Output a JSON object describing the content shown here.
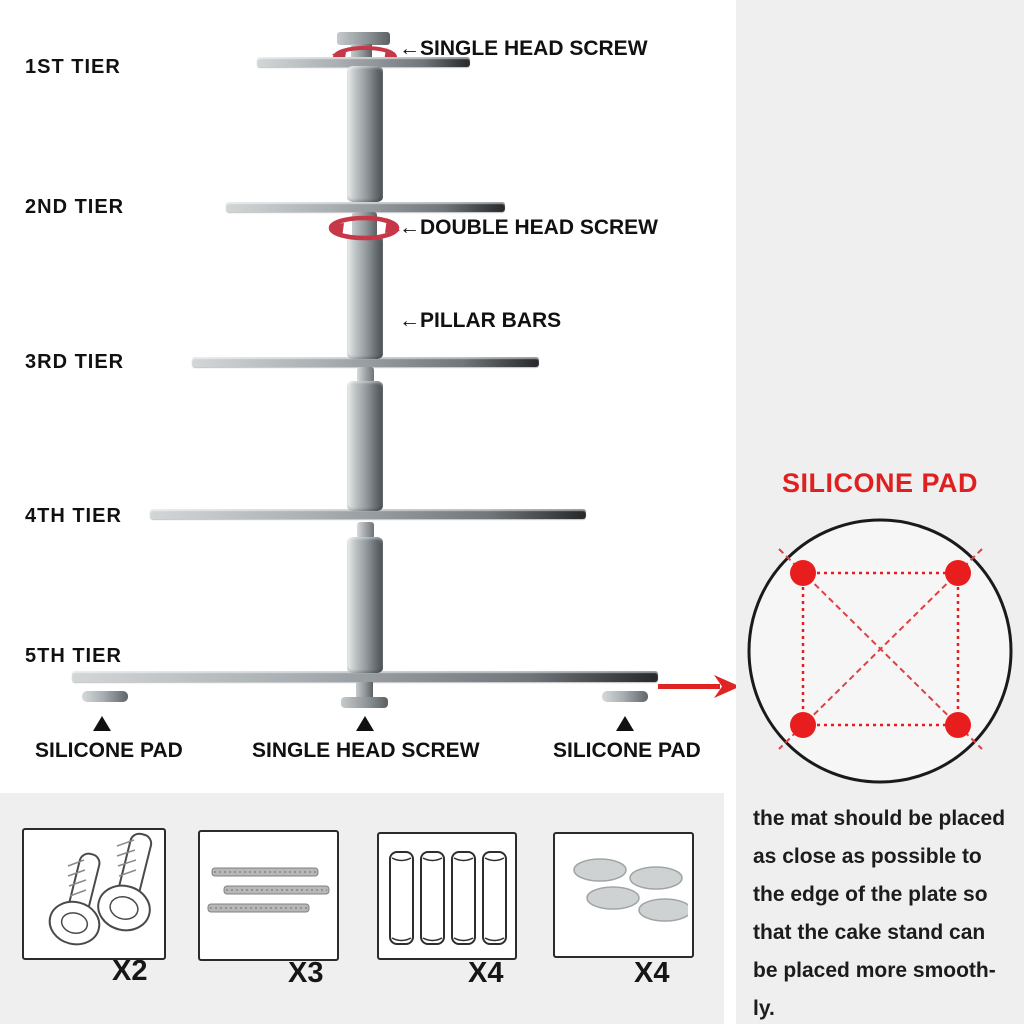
{
  "colors": {
    "accent_red": "#e02020",
    "rotation_arrow_red": "#c63848",
    "panel_bg": "#efefef",
    "ink": "#111111"
  },
  "diagram": {
    "tiers": [
      {
        "label": "1ST TIER"
      },
      {
        "label": "2ND TIER"
      },
      {
        "label": "3RD TIER"
      },
      {
        "label": "4TH TIER"
      },
      {
        "label": "5TH TIER"
      }
    ],
    "callouts": {
      "single_head_screw": "←SINGLE HEAD SCREW",
      "double_head_screw": "←DOUBLE HEAD SCREW",
      "pillar_bars": "←PILLAR BARS"
    },
    "base_labels": {
      "left_pad": "SILICONE PAD",
      "center_screw": "SINGLE HEAD SCREW",
      "right_pad": "SILICONE PAD"
    }
  },
  "side_panel": {
    "title": "SILICONE PAD",
    "description_lines": [
      "the mat should be placed",
      "as close as possible to",
      "the edge of the plate so",
      "that the cake stand can",
      "be placed more smooth-",
      "ly."
    ]
  },
  "parts": [
    {
      "name": "single-head-screws",
      "count": "X2"
    },
    {
      "name": "double-head-screw-bars",
      "count": "X3"
    },
    {
      "name": "pillar-bars",
      "count": "X4"
    },
    {
      "name": "silicone-pads",
      "count": "X4"
    }
  ]
}
